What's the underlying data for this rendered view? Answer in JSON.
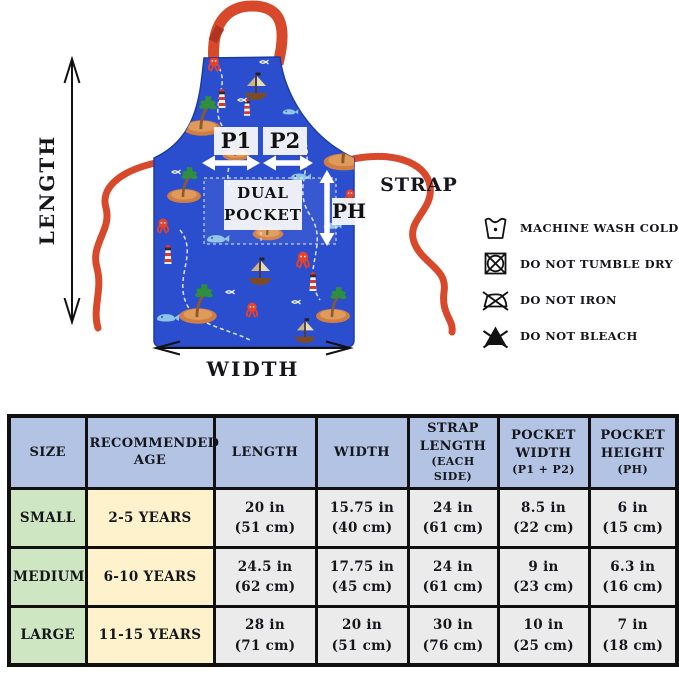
{
  "diagram": {
    "length_label": "LENGTH",
    "width_label": "WIDTH",
    "strap_label": "STRAP",
    "p1_label": "P1",
    "p2_label": "P2",
    "dual_pocket_label": "DUAL POCKET",
    "ph_label": "PH",
    "care_instructions": [
      {
        "icon": "machine-wash-cold-icon",
        "label": "MACHINE WASH COLD"
      },
      {
        "icon": "do-not-tumble-dry-icon",
        "label": "DO NOT TUMBLE DRY"
      },
      {
        "icon": "do-not-iron-icon",
        "label": "DO NOT IRON"
      },
      {
        "icon": "do-not-bleach-icon",
        "label": "DO NOT BLEACH"
      }
    ]
  },
  "size_table": {
    "headers": [
      {
        "title": "SIZE",
        "sub": ""
      },
      {
        "title": "RECOMMENDED AGE",
        "sub": ""
      },
      {
        "title": "LENGTH",
        "sub": ""
      },
      {
        "title": "WIDTH",
        "sub": ""
      },
      {
        "title": "STRAP LENGTH",
        "sub": "(EACH SIDE)"
      },
      {
        "title": "POCKET WIDTH",
        "sub": "(P1 + P2)"
      },
      {
        "title": "POCKET HEIGHT",
        "sub": "(PH)"
      }
    ],
    "rows": [
      {
        "size": "SMALL",
        "age": "2-5 YEARS",
        "length": [
          "20 in",
          "(51 cm)"
        ],
        "width": [
          "15.75 in",
          "(40 cm)"
        ],
        "strap": [
          "24 in",
          "(61 cm)"
        ],
        "pocket_width": [
          "8.5 in",
          "(22 cm)"
        ],
        "pocket_height": [
          "6 in",
          "(15 cm)"
        ]
      },
      {
        "size": "MEDIUM",
        "age": "6-10 YEARS",
        "length": [
          "24.5 in",
          "(62 cm)"
        ],
        "width": [
          "17.75 in",
          "(45 cm)"
        ],
        "strap": [
          "24 in",
          "(61 cm)"
        ],
        "pocket_width": [
          "9 in",
          "(23 cm)"
        ],
        "pocket_height": [
          "6.3 in",
          "(16 cm)"
        ]
      },
      {
        "size": "LARGE",
        "age": "11-15 YEARS",
        "length": [
          "28 in",
          "(71 cm)"
        ],
        "width": [
          "20 in",
          "(51 cm)"
        ],
        "strap": [
          "30 in",
          "(76 cm)"
        ],
        "pocket_width": [
          "10 in",
          "(25 cm)"
        ],
        "pocket_height": [
          "7 in",
          "(18 cm)"
        ]
      }
    ]
  },
  "colors": {
    "apron_blue": "#2b4ecf",
    "strap_red": "#d8492c",
    "table_header_blue": "#b3c3e3",
    "size_col_green": "#cfe6c3",
    "age_col_yellow": "#fdf2cc",
    "data_cell_gray": "#ebebeb",
    "border_black": "#101010"
  }
}
